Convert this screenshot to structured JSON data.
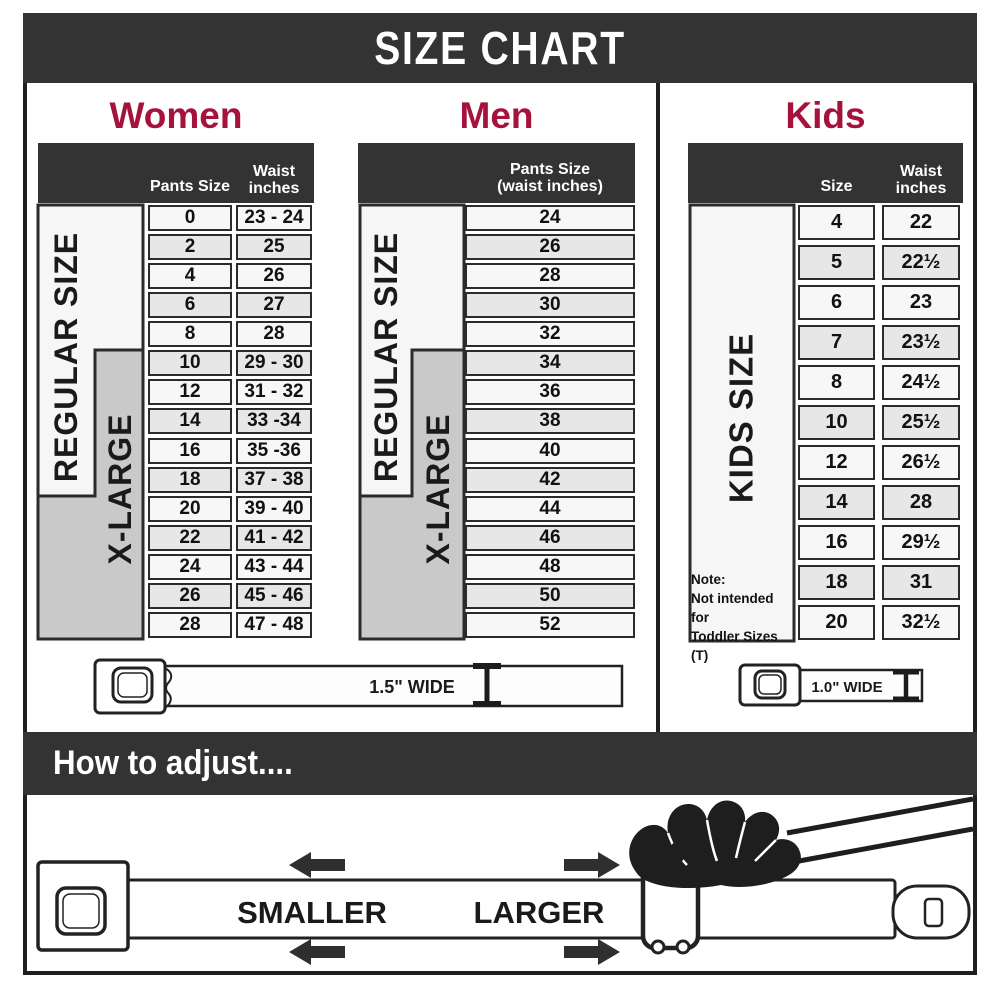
{
  "banner": {
    "title": "SIZE CHART"
  },
  "colors": {
    "accent": "#A5123C",
    "band_dark": "#333333",
    "row_light": "#f7f7f7",
    "row_shaded": "#e7e7e7",
    "xlarge_gray": "#c9c9c9",
    "regular_white": "#f6f6f6"
  },
  "ui": {
    "women_header": {
      "col1": "Pants Size",
      "col2a": "Waist",
      "col2b": "inches"
    },
    "men_header": {
      "line1": "Pants Size",
      "line2": "(waist inches)"
    },
    "kids_header": {
      "col1": "Size",
      "col2a": "Waist",
      "col2b": "inches"
    },
    "kids_note": [
      "Note:",
      "Not intended for",
      "Toddler Sizes (T)"
    ],
    "belt_adult": "1.5\" WIDE",
    "belt_kids": "1.0\" WIDE",
    "adjust_title": "How to adjust....",
    "smaller": "SMALLER",
    "larger": "LARGER"
  },
  "chart_data": [
    {
      "type": "table",
      "title": "Women",
      "columns": [
        "Pants Size",
        "Waist inches"
      ],
      "rows": [
        [
          "0",
          "23 - 24"
        ],
        [
          "2",
          "25"
        ],
        [
          "4",
          "26"
        ],
        [
          "6",
          "27"
        ],
        [
          "8",
          "28"
        ],
        [
          "10",
          "29 - 30"
        ],
        [
          "12",
          "31 - 32"
        ],
        [
          "14",
          "33 -34"
        ],
        [
          "16",
          "35 -36"
        ],
        [
          "18",
          "37 - 38"
        ],
        [
          "20",
          "39 - 40"
        ],
        [
          "22",
          "41 - 42"
        ],
        [
          "24",
          "43 - 44"
        ],
        [
          "26",
          "45 - 46"
        ],
        [
          "28",
          "47 - 48"
        ]
      ],
      "groups": [
        {
          "label": "REGULAR SIZE",
          "covers": "sizes 0-18"
        },
        {
          "label": "X-LARGE",
          "covers": "sizes 10-28"
        }
      ]
    },
    {
      "type": "table",
      "title": "Men",
      "columns": [
        "Pants Size (waist inches)"
      ],
      "rows": [
        [
          "24"
        ],
        [
          "26"
        ],
        [
          "28"
        ],
        [
          "30"
        ],
        [
          "32"
        ],
        [
          "34"
        ],
        [
          "36"
        ],
        [
          "38"
        ],
        [
          "40"
        ],
        [
          "42"
        ],
        [
          "44"
        ],
        [
          "46"
        ],
        [
          "48"
        ],
        [
          "50"
        ],
        [
          "52"
        ]
      ],
      "groups": [
        {
          "label": "REGULAR SIZE",
          "covers": "sizes 24-42"
        },
        {
          "label": "X-LARGE",
          "covers": "sizes 34-52"
        }
      ]
    },
    {
      "type": "table",
      "title": "Kids",
      "columns": [
        "Size",
        "Waist inches"
      ],
      "rows": [
        [
          "4",
          "22"
        ],
        [
          "5",
          "22½"
        ],
        [
          "6",
          "23"
        ],
        [
          "7",
          "23½"
        ],
        [
          "8",
          "24½"
        ],
        [
          "10",
          "25½"
        ],
        [
          "12",
          "26½"
        ],
        [
          "14",
          "28"
        ],
        [
          "16",
          "29½"
        ],
        [
          "18",
          "31"
        ],
        [
          "20",
          "32½"
        ]
      ],
      "groups": [
        {
          "label": "KIDS SIZE",
          "covers": "sizes 4-20"
        }
      ]
    }
  ]
}
